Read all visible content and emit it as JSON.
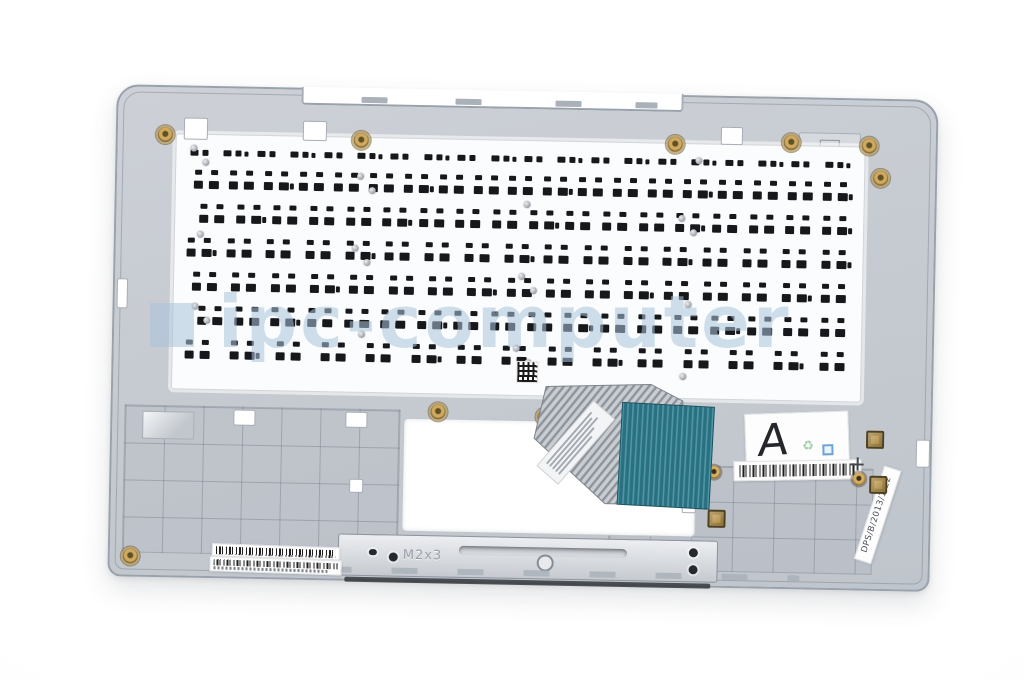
{
  "scene": {
    "type": "product photo",
    "subject": "laptop palmrest top case with keyboard module, rear inner view",
    "background_color": "#ffffff"
  },
  "watermark": {
    "text": "ipc-computer",
    "color": "#a9c1d8"
  },
  "palmrest": {
    "body_color": "#c7ccd2",
    "edge_color": "#99a1ab"
  },
  "keyboard_plate": {
    "color": "#fbfcfd",
    "cutout_color": "#17181b",
    "rows": [
      {
        "keys": 20
      },
      {
        "keys": 19
      },
      {
        "keys": 18
      },
      {
        "keys": 17
      },
      {
        "keys": 17
      },
      {
        "keys": 18
      },
      {
        "keys": 15
      }
    ]
  },
  "touchpad_cutout": {
    "color": "#ffffff"
  },
  "flex_cable": {
    "film_color": "#c6cad0",
    "connector_color": "#2e7586"
  },
  "bracket": {
    "label": "M2x3",
    "color": "#d6d9de"
  },
  "stickers": {
    "grade": {
      "text": "A"
    },
    "date_code": {
      "text": "DPS/B/2013/1/22"
    },
    "barcode_label_count": 3
  },
  "hardware": {
    "brass_color": "#c3a05e",
    "screw_color": "#aab0b8"
  }
}
